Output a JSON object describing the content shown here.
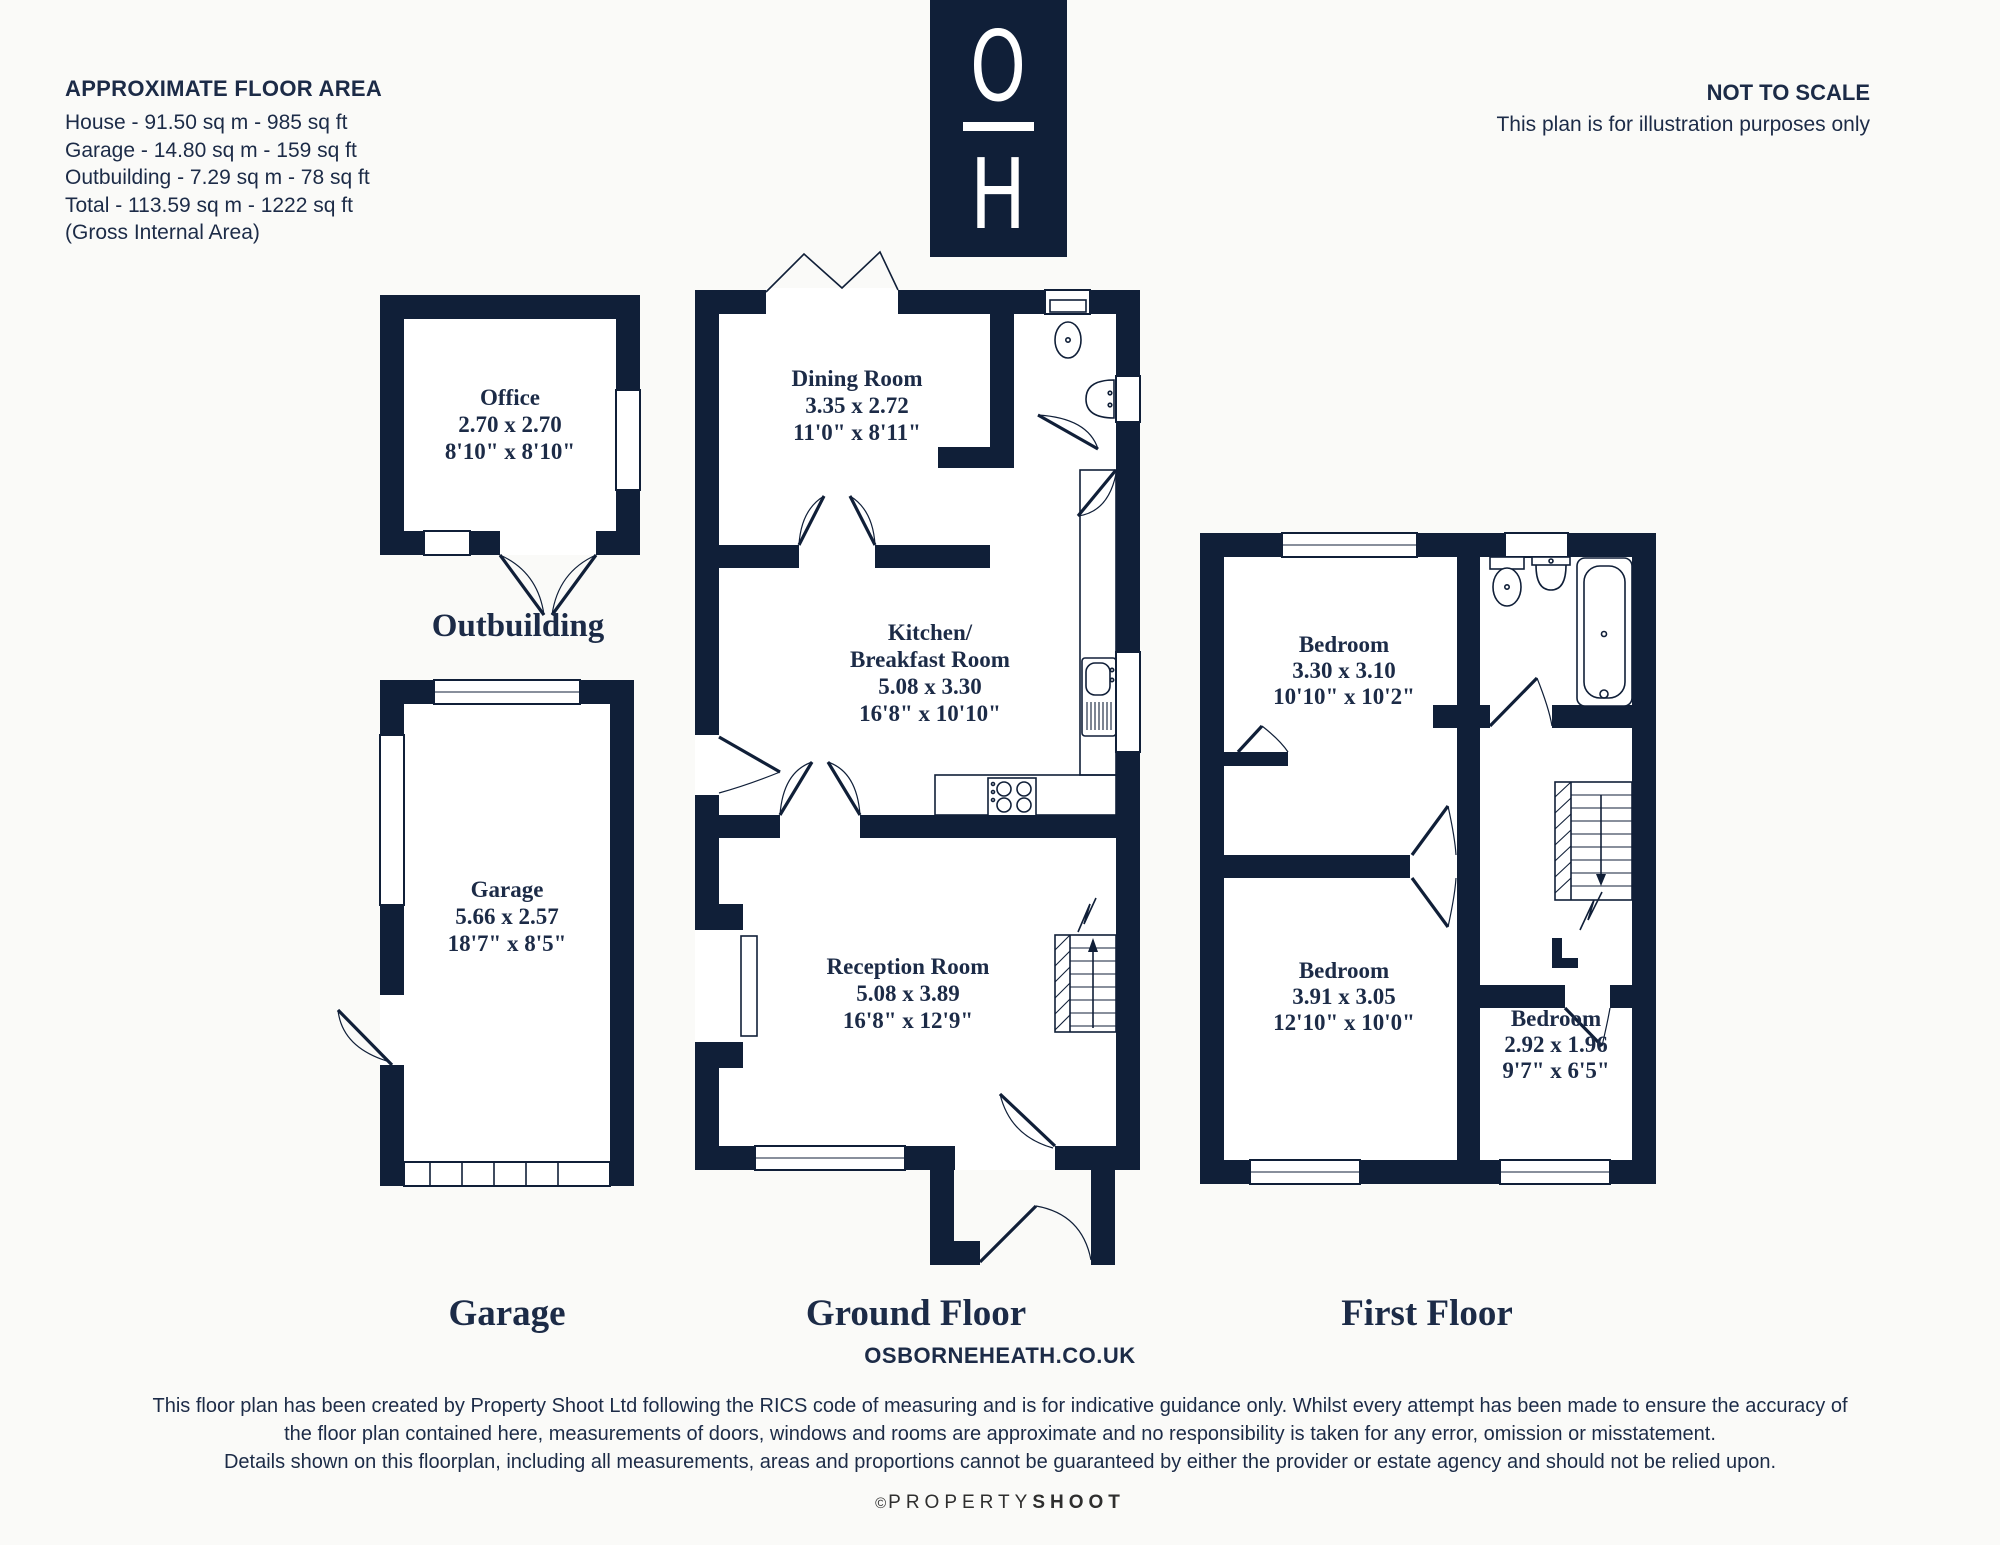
{
  "colors": {
    "wall": "#101f38",
    "text": "#1c2b47",
    "bg": "#fafaf8"
  },
  "header": {
    "area_title": "APPROXIMATE FLOOR AREA",
    "area_lines": [
      "House - 91.50 sq m - 985 sq ft",
      "Garage - 14.80 sq m - 159 sq ft",
      "Outbuilding - 7.29 sq m - 78 sq ft",
      "Total - 113.59 sq m - 1222 sq ft",
      "(Gross Internal Area)"
    ],
    "not_to_scale": "NOT TO SCALE",
    "illustration_note": "This plan is for illustration purposes only",
    "logo": {
      "letter_top": "O",
      "letter_bottom": "H"
    }
  },
  "rooms": {
    "office": {
      "name": "Office",
      "metric": "2.70 x 2.70",
      "imperial": "8'10\" x 8'10\""
    },
    "garage": {
      "name": "Garage",
      "metric": "5.66 x 2.57",
      "imperial": "18'7\" x 8'5\""
    },
    "dining": {
      "name": "Dining Room",
      "metric": "3.35 x 2.72",
      "imperial": "11'0\" x 8'11\""
    },
    "kitchen": {
      "name1": "Kitchen/",
      "name2": "Breakfast Room",
      "metric": "5.08 x 3.30",
      "imperial": "16'8\" x 10'10\""
    },
    "reception": {
      "name": "Reception Room",
      "metric": "5.08 x 3.89",
      "imperial": "16'8\" x 12'9\""
    },
    "bedroom1": {
      "name": "Bedroom",
      "metric": "3.30 x 3.10",
      "imperial": "10'10\" x 10'2\""
    },
    "bedroom2": {
      "name": "Bedroom",
      "metric": "3.91 x 3.05",
      "imperial": "12'10\" x 10'0\""
    },
    "bedroom3": {
      "name": "Bedroom",
      "metric": "2.92 x 1.96",
      "imperial": "9'7\" x 6'5\""
    }
  },
  "floor_labels": {
    "outbuilding": "Outbuilding",
    "garage": "Garage",
    "ground": "Ground Floor",
    "first": "First Floor"
  },
  "footer": {
    "website": "OSBORNEHEATH.CO.UK",
    "disclaimer_lines": [
      "This floor plan has been created by Property Shoot Ltd following the RICS code of measuring and is for indicative guidance only. Whilst every attempt has been made to ensure the accuracy of",
      "the floor plan contained here, measurements of doors, windows and rooms are approximate and no responsibility is taken for any error, omission or misstatement.",
      "Details shown on this floorplan, including all measurements, areas and proportions cannot be guaranteed by either the provider or estate agency and should not be relied upon."
    ],
    "credit": {
      "symbol": "©",
      "light": "PROPERTY",
      "bold": "SHOOT"
    }
  }
}
